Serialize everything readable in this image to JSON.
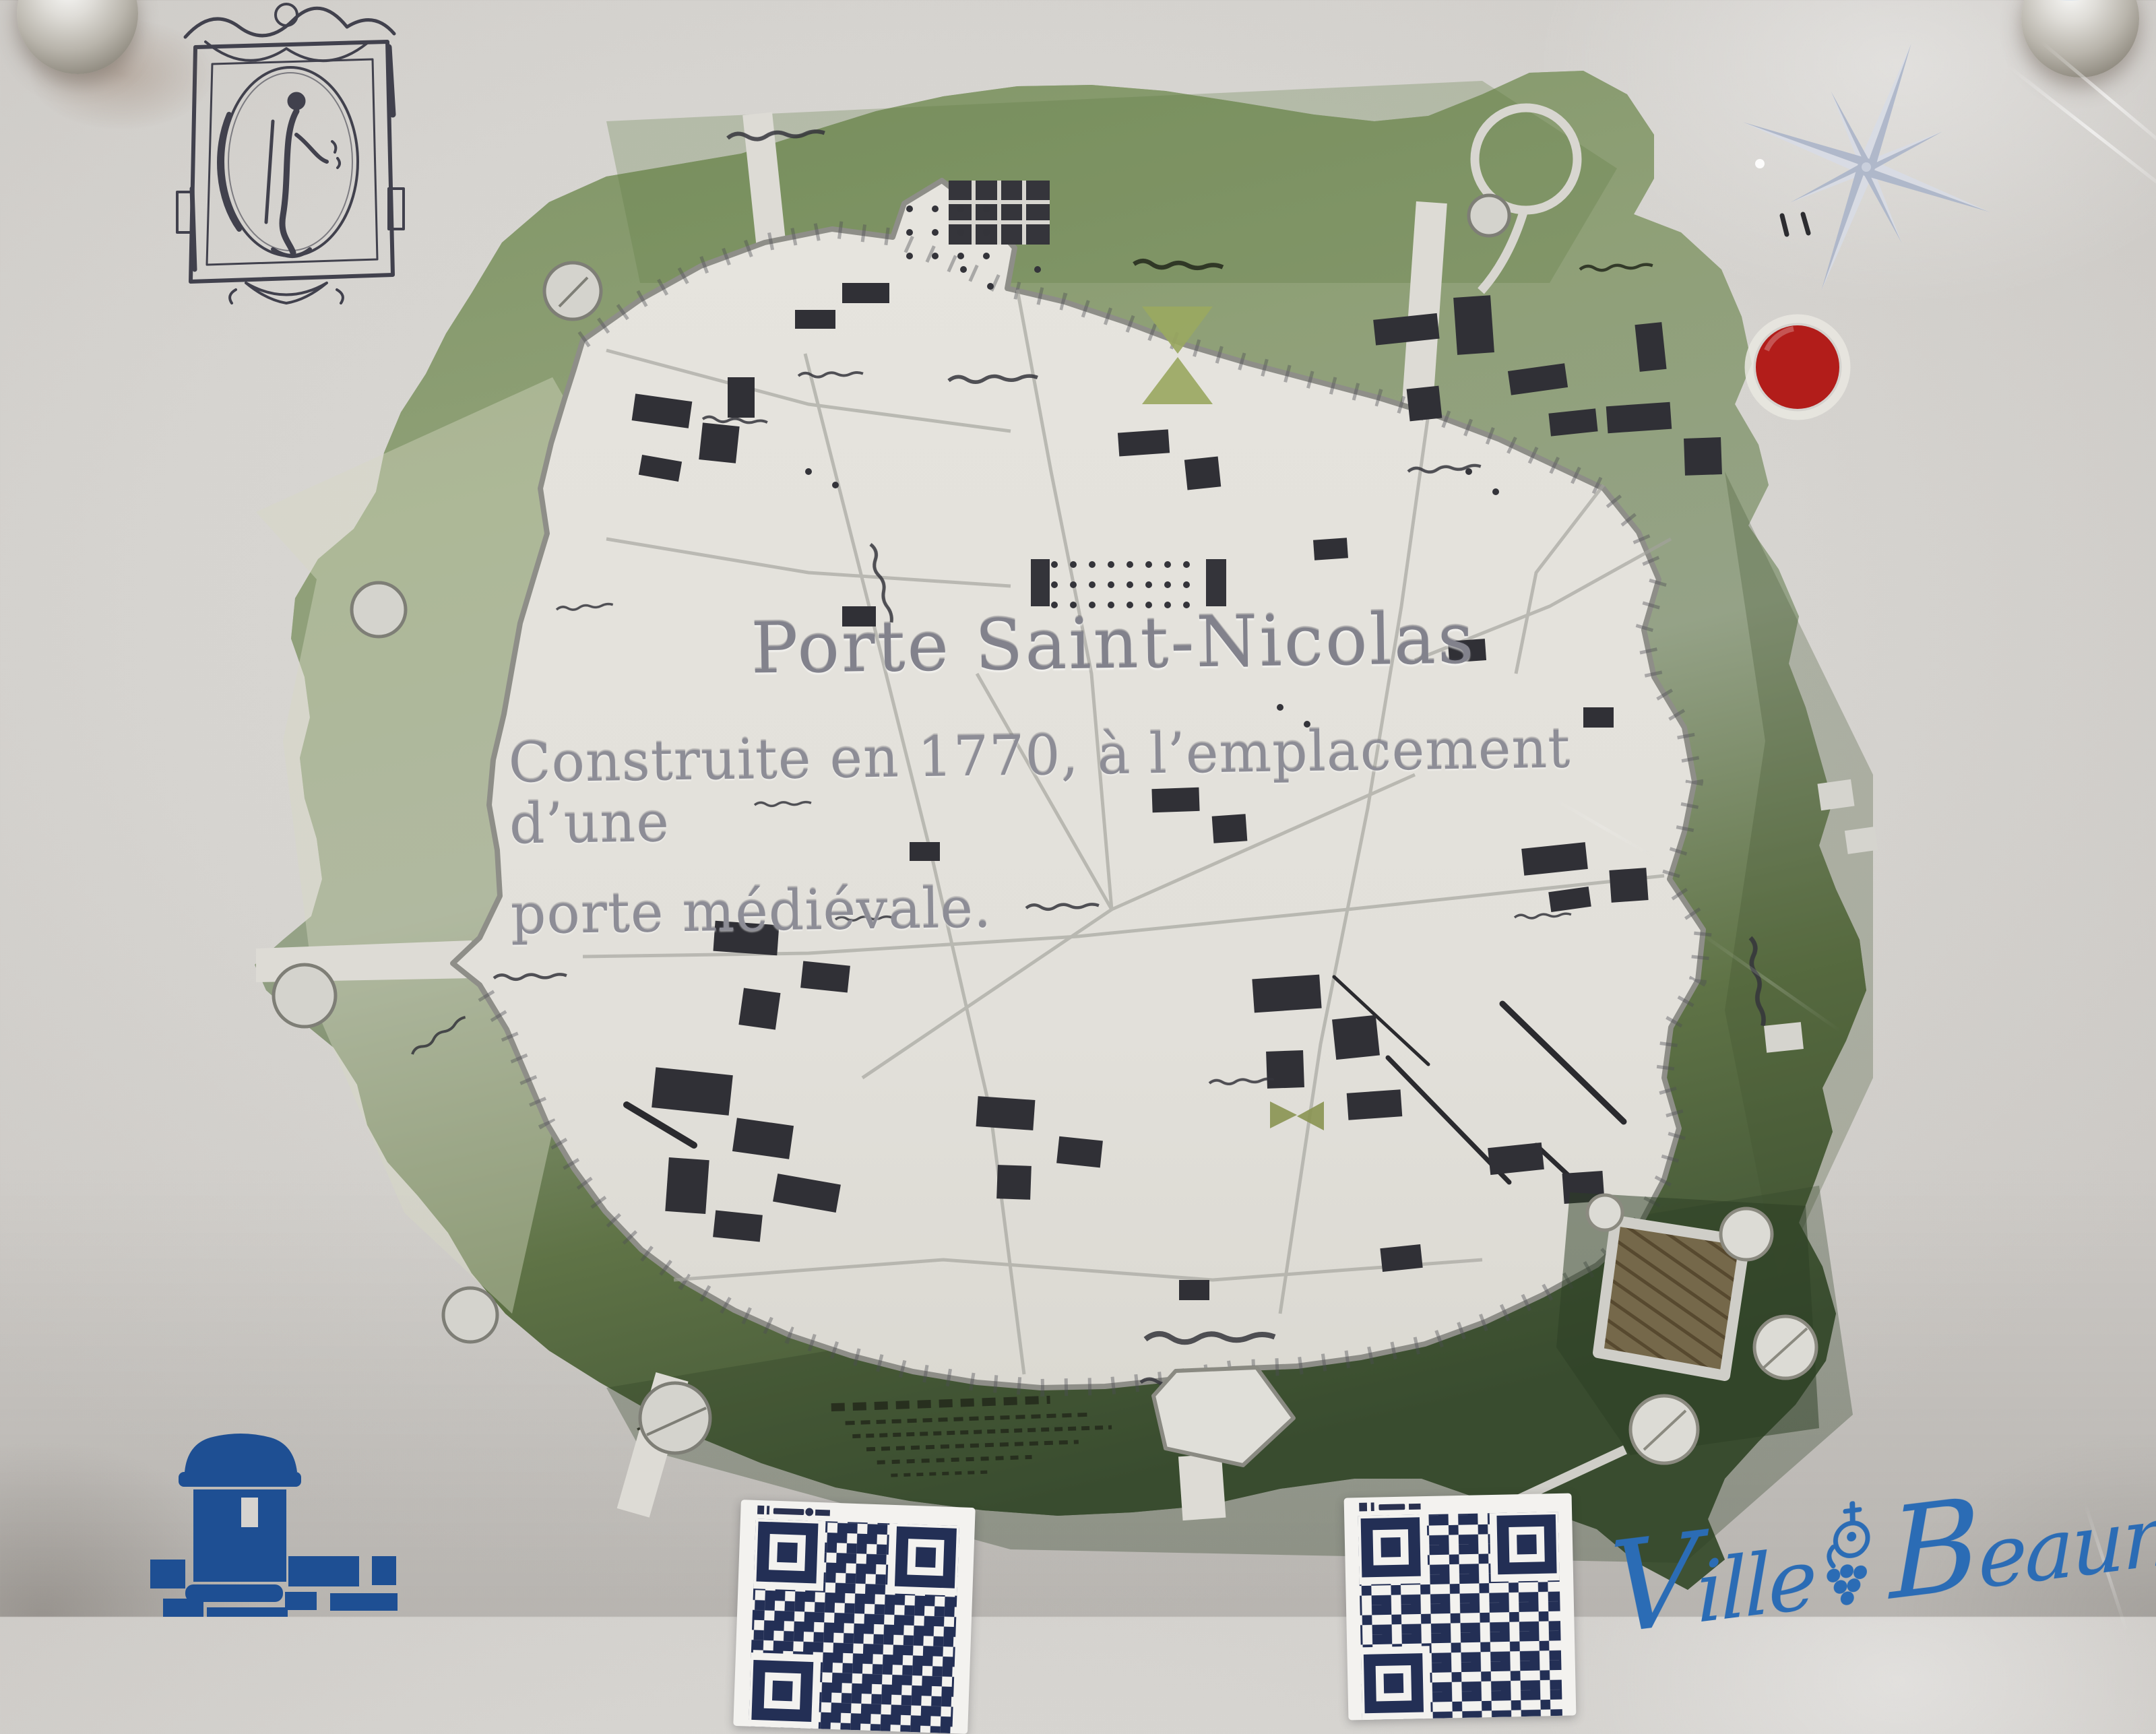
{
  "panel": {
    "title": "Porte Saint-Nicolas",
    "subtitle_line_1": "Construite en 1770, à l’emplacement d’une",
    "subtitle_line_2": "porte médiévale."
  },
  "logo": {
    "word_1": "Ville",
    "word_2": "Beaune"
  },
  "colors": {
    "background_grey": "#d6d4d0",
    "rampart_green_light": "#8ba073",
    "rampart_green_dark": "#46583a",
    "map_parchment": "#e4e2dc",
    "engraved_text_grey": "#8b8b92",
    "marker_red": "#b21d1a",
    "qr_navy": "#232f55",
    "pictogram_blue": "#1e4f93",
    "logo_blue": "#2b6cb5",
    "compass_blue_grey": "#b9c2d4",
    "fort_brown": "#75684a"
  },
  "icons": {
    "compass_rose": "eight-point-star",
    "you_are_here": "filled-red-circle",
    "corner_screw": "metal-dome-bolt",
    "rampart_tower": "dome-tower-pictogram",
    "qr_code": "qr-square-modules",
    "engraving": "saint-nicolas-medallion-etching",
    "grape_cluster": "grape-bunch-with-cross"
  }
}
